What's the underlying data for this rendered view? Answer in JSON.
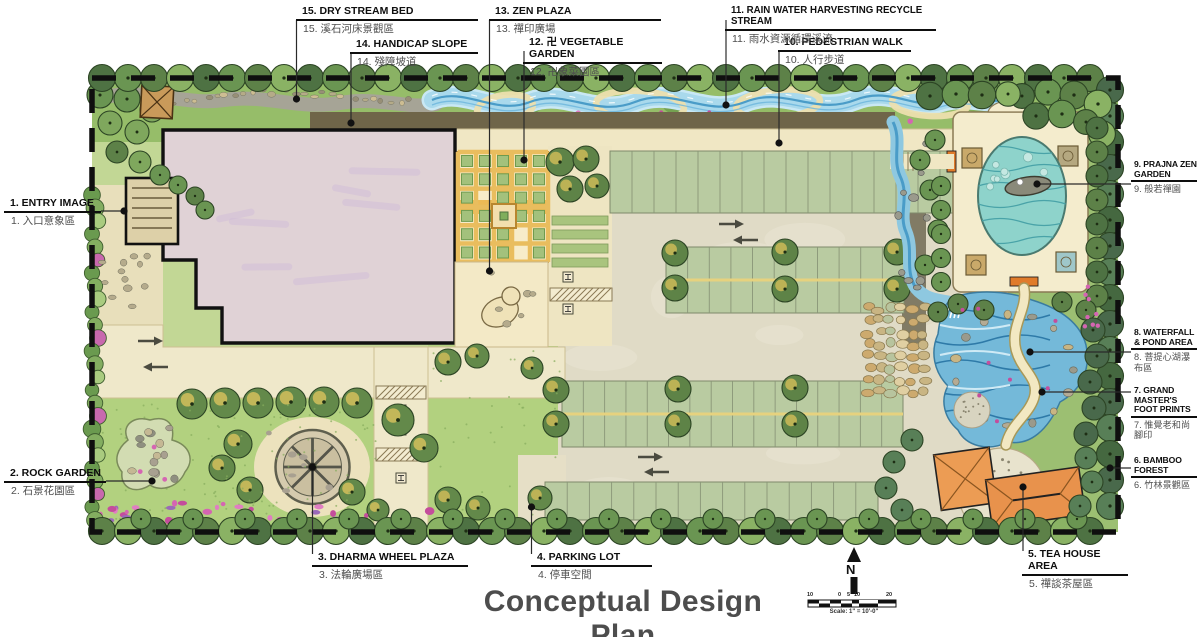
{
  "plan": {
    "title": "Conceptual Design Plan"
  },
  "callouts": [
    {
      "num": "1",
      "en": "1. ENTRY IMAGE",
      "zh": "1. 入口意象區"
    },
    {
      "num": "2",
      "en": "2. ROCK GARDEN",
      "zh": "2. 石景花園區"
    },
    {
      "num": "3",
      "en": "3. DHARMA WHEEL PLAZA",
      "zh": "3. 法輪廣場區"
    },
    {
      "num": "4",
      "en": "4. PARKING LOT",
      "zh": "4. 停車空間"
    },
    {
      "num": "5",
      "en": "5. TEA HOUSE AREA",
      "zh": "5. 禪談茶屋區"
    },
    {
      "num": "6",
      "en": "6. BAMBOO FOREST",
      "zh": "6. 竹林景觀區"
    },
    {
      "num": "7",
      "en": "7. GRAND MASTER'S\nFOOT PRINTS",
      "zh": "7. 惟覺老和尚腳印"
    },
    {
      "num": "8",
      "en": "8. WATERFALL\n& POND AREA",
      "zh": "8. 菩提心湖瀑布區"
    },
    {
      "num": "9",
      "en": "9. PRAJNA ZEN\nGARDEN",
      "zh": "9. 般若禪園"
    },
    {
      "num": "10",
      "en": "10. PEDESTRIAN WALK",
      "zh": "10. 人行步道"
    },
    {
      "num": "11",
      "en": "11. RAIN WATER HARVESTING RECYCLE STREAM",
      "zh": "11. 雨水資源循環溪流"
    },
    {
      "num": "12",
      "en": "12. 卍 VEGETABLE GARDEN",
      "zh": "12. 卍象菜園區"
    },
    {
      "num": "13",
      "en": "13. ZEN PLAZA",
      "zh": "13. 禪印廣場"
    },
    {
      "num": "14",
      "en": "14. HANDICAP SLOPE",
      "zh": "14. 殘障坡道"
    },
    {
      "num": "15",
      "en": "15. DRY STREAM BED",
      "zh": "15. 溪石河床景觀區"
    }
  ],
  "compass": {
    "label": "N"
  },
  "scale_bar": {
    "ticks": [
      "10",
      "0",
      "5",
      "10",
      "20"
    ],
    "caption": "Scale: 1\" = 10'-0\""
  },
  "colors": {
    "water": "#a9d9ec",
    "pond": "#8ed3cb",
    "canopy": "#5d8148",
    "roof": "#ec9c54",
    "building": "#e0d2d6",
    "pavement": "#efe8ca",
    "flower": "#d565b2",
    "ink": "#111111"
  }
}
